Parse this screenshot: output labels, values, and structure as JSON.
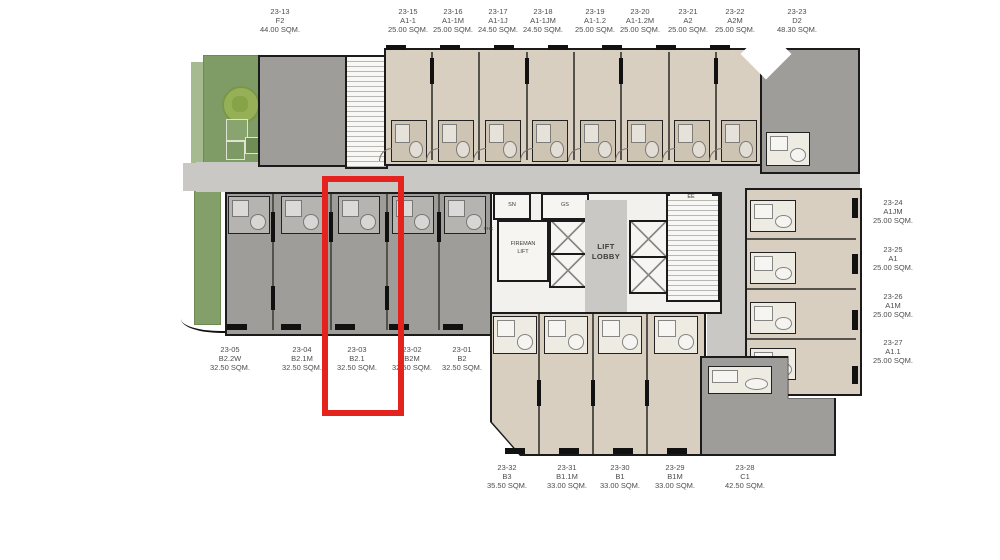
{
  "colors": {
    "unit_beige": "#d8cfc0",
    "unit_gray": "#9e9d9a",
    "corridor_gray": "#c9c8c5",
    "wall_black": "#1b1b1b",
    "garden_green": "#809c66",
    "tree_green": "#95b057",
    "highlight_red": "#e5231e",
    "label_text": "#4d4d4d"
  },
  "plan": {
    "top_units": [
      {
        "id": "23-13",
        "type": "F2",
        "area": "44.00 SQM."
      },
      {
        "id": "23-15",
        "type": "A1-1",
        "area": "25.00 SQM."
      },
      {
        "id": "23-16",
        "type": "A1-1M",
        "area": "25.00 SQM."
      },
      {
        "id": "23-17",
        "type": "A1-1J",
        "area": "24.50 SQM."
      },
      {
        "id": "23-18",
        "type": "A1-1JM",
        "area": "24.50 SQM."
      },
      {
        "id": "23-19",
        "type": "A1-1.2",
        "area": "25.00 SQM."
      },
      {
        "id": "23-20",
        "type": "A1-1.2M",
        "area": "25.00 SQM."
      },
      {
        "id": "23-21",
        "type": "A2",
        "area": "25.00 SQM."
      },
      {
        "id": "23-22",
        "type": "A2M",
        "area": "25.00 SQM."
      },
      {
        "id": "23-23",
        "type": "D2",
        "area": "48.30 SQM."
      }
    ],
    "right_units": [
      {
        "id": "23-24",
        "type": "A1JM",
        "area": "25.00 SQM."
      },
      {
        "id": "23-25",
        "type": "A1",
        "area": "25.00 SQM."
      },
      {
        "id": "23-26",
        "type": "A1M",
        "area": "25.00 SQM."
      },
      {
        "id": "23-27",
        "type": "A1.1",
        "area": "25.00 SQM."
      }
    ],
    "middle_units": [
      {
        "id": "23-05",
        "type": "B2.2W",
        "area": "32.50 SQM."
      },
      {
        "id": "23-04",
        "type": "B2.1M",
        "area": "32.50 SQM."
      },
      {
        "id": "23-03",
        "type": "B2.1",
        "area": "32.50 SQM."
      },
      {
        "id": "23-02",
        "type": "B2M",
        "area": "32.50 SQM."
      },
      {
        "id": "23-01",
        "type": "B2",
        "area": "32.50 SQM."
      }
    ],
    "bottom_units": [
      {
        "id": "23-32",
        "type": "B3",
        "area": "35.50 SQM."
      },
      {
        "id": "23-31",
        "type": "B1.1M",
        "area": "33.00 SQM."
      },
      {
        "id": "23-30",
        "type": "B1",
        "area": "33.00 SQM."
      },
      {
        "id": "23-29",
        "type": "B1M",
        "area": "33.00 SQM."
      },
      {
        "id": "23-28",
        "type": "C1",
        "area": "42.50 SQM."
      }
    ],
    "core": {
      "sn": "SN",
      "gs": "GS",
      "ee": "EE",
      "fhc": "FHC",
      "fireman_line1": "FIREMAN",
      "fireman_line2": "LIFT",
      "lobby_line1": "LIFT",
      "lobby_line2": "LOBBY"
    }
  }
}
